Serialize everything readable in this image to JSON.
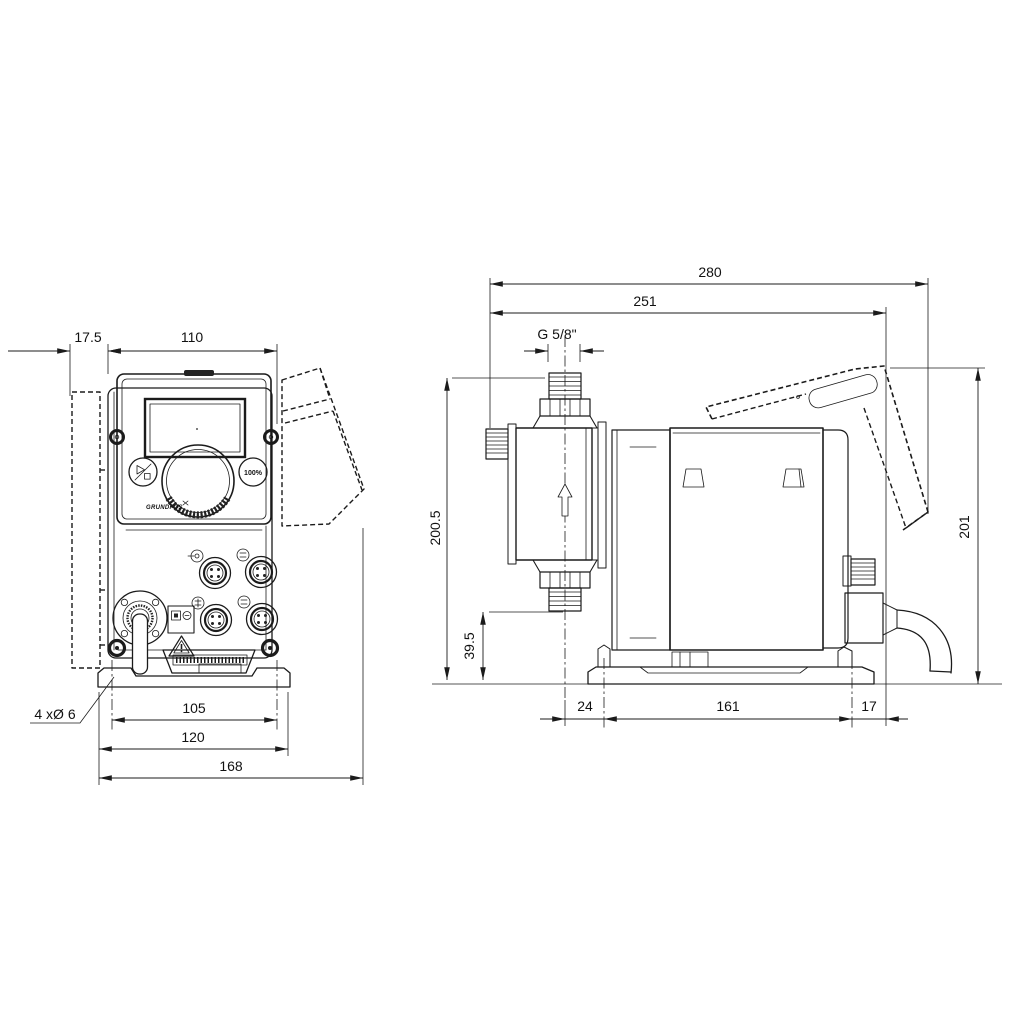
{
  "drawing_type": "dimensional-outline-drawing",
  "views": {
    "left": "front view",
    "right": "side view"
  },
  "colors": {
    "line": "#1b1b1b",
    "background": "#ffffff"
  },
  "dimensions": {
    "front": {
      "offset": "17.5",
      "width": "110",
      "hole_spacing": "105",
      "plate_width": "120",
      "overall_width": "168",
      "mounting_holes": "4 xØ 6"
    },
    "side": {
      "overall_depth": "280",
      "depth_to_gland": "251",
      "connection_thread": "G 5/8\"",
      "overall_height": "200.5",
      "valve_height": "39.5",
      "control_cube_height": "201",
      "foot_front_offset": "24",
      "foot_hole_spacing": "161",
      "foot_rear_offset": "17"
    }
  },
  "control_panel": {
    "capacity_button_label": "100%",
    "brand": "GRUNDFOS"
  },
  "icons": {
    "start_stop": "play-stop-icon",
    "flow_direction": "up-arrow-icon",
    "warning": "warning-triangle-icon",
    "connectors": "m12-connector-icon"
  }
}
